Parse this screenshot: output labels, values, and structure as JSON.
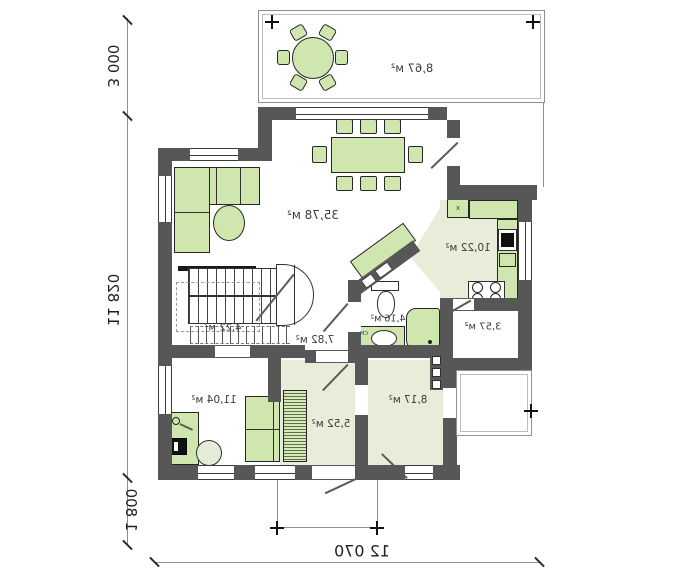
{
  "drawing": {
    "kind": "house floor plan (mirrored print)"
  },
  "dimensions": {
    "top_left_vertical": "3 000",
    "left_vertical": "11 820",
    "bottom_left_vertical": "1 800",
    "bottom_horizontal": "12 070"
  },
  "rooms": {
    "terrace": "8,67 м²",
    "living": "35,78 м²",
    "kitchen": "10,22 м²",
    "pantry": "3,57 м²",
    "bathroom": "4,16 м²",
    "stairs": "4,22 м²",
    "hall": "7,82 м²",
    "office": "11,04 м²",
    "vestibule": "5,52 м²",
    "entry": "8,17 м²"
  },
  "small_labels": {
    "washer": "СМ",
    "kitchen_unit": "x"
  },
  "colors": {
    "wall": "#575757",
    "furniture_fill": "#cfe7ae",
    "room_tint": "#e9ecd8",
    "outline": "#8f8f8f",
    "text": "#3b3b3b"
  }
}
